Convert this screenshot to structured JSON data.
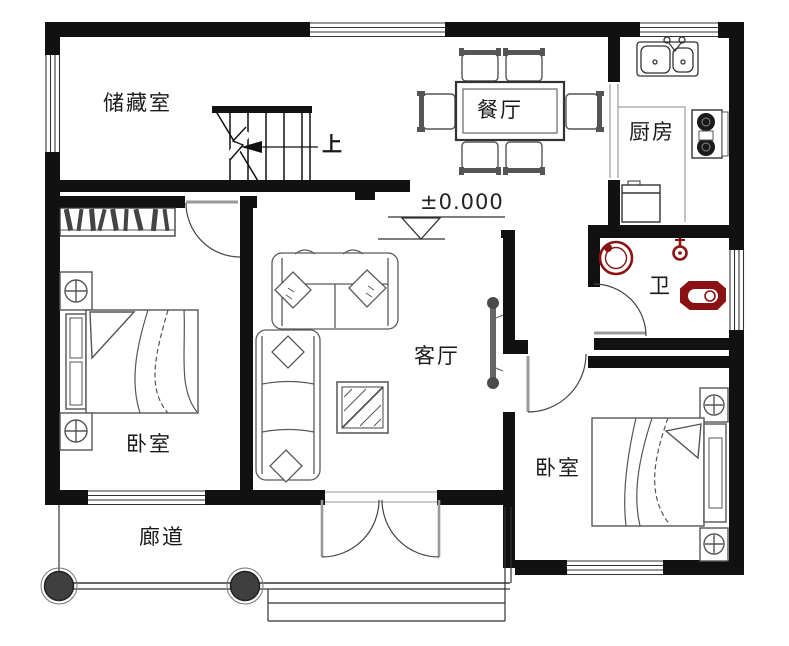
{
  "labels": {
    "storage": "储藏室",
    "dining": "餐厅",
    "kitchen": "厨房",
    "bathroom": "卫",
    "living": "客厅",
    "bedroom_left": "卧室",
    "bedroom_right": "卧室",
    "corridor": "廊道"
  },
  "annotations": {
    "stairs_direction": "上",
    "floor_elevation": "±0.000"
  },
  "colors": {
    "wall": "#111111",
    "thin_line": "#333333",
    "door_leaf": "#999999",
    "furniture_line": "#555555",
    "fixture_red": "#8a1212",
    "column_fill": "#3f3f3f"
  }
}
